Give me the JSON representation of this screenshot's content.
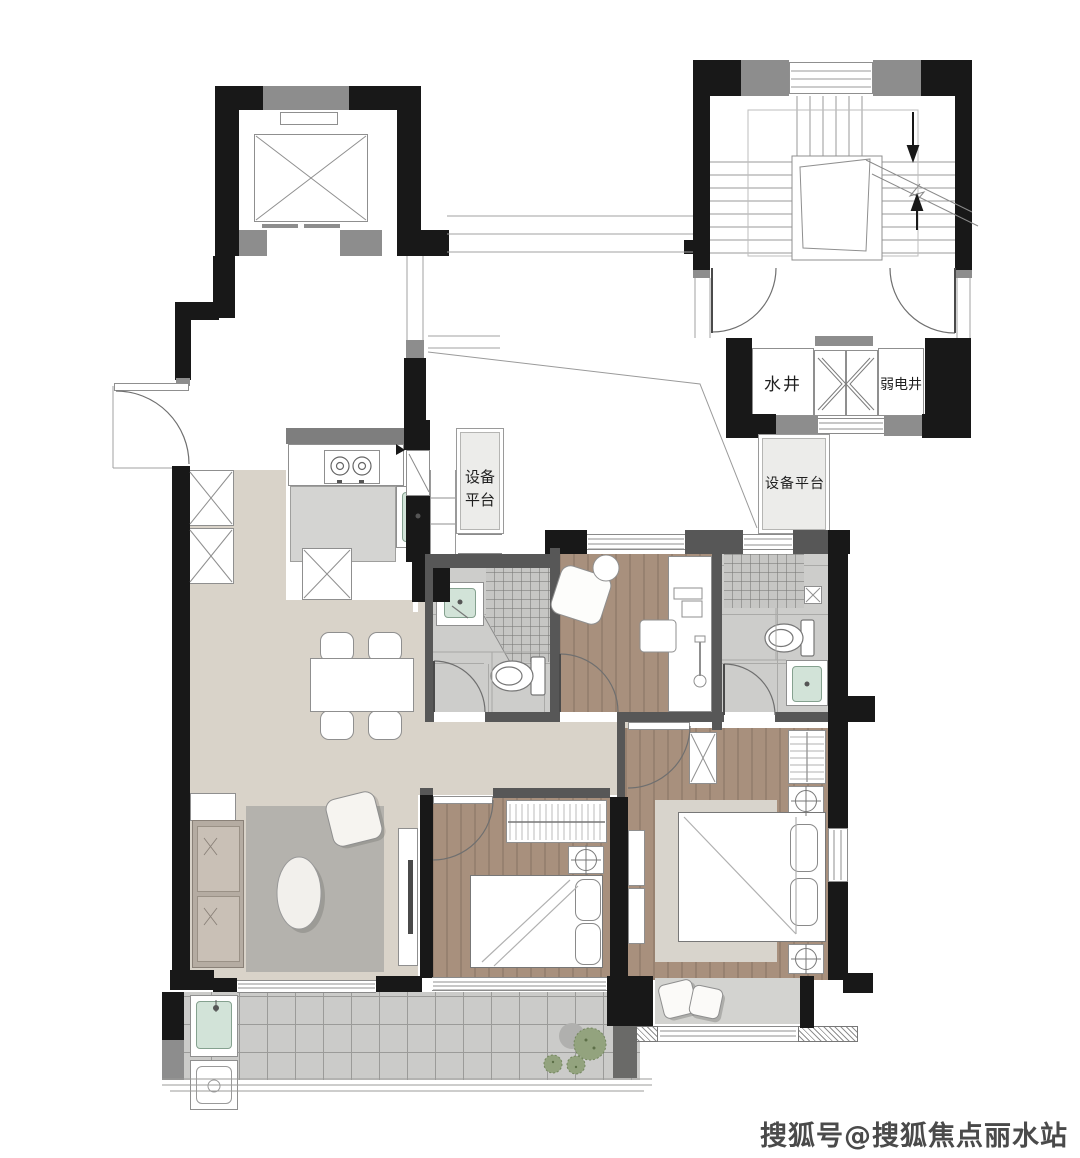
{
  "page": {
    "background": "#ffffff",
    "width_px": 1080,
    "height_px": 1158
  },
  "floor_plan": {
    "shaft_labels": {
      "water_shaft": "水井",
      "weak_electric_shaft": "弱电井"
    },
    "equipment_platform_left": {
      "line1": "设备",
      "line2": "平台"
    },
    "equipment_platform_right": "设备平台",
    "colors": {
      "wall_black": "#181818",
      "wall_gray": "#8d8d8d",
      "partition_gray": "#575757",
      "kitchen_wall_gray": "#7e7e7e",
      "living_floor": "#d9d3c9",
      "wood_floor": "#a8907d",
      "bath_tile": "#cdcdcb",
      "balcony_tile": "#cbcbc9",
      "rug_living": "#b4b2ad",
      "rug_master": "#d8d4cc",
      "sofa": "#b5aca2",
      "sink_green": "#d2e3d8",
      "plant_green": "#93a37e",
      "bay_seat": "#d3d3d0"
    }
  },
  "watermark": {
    "text": "搜狐号@搜狐焦点丽水站"
  }
}
